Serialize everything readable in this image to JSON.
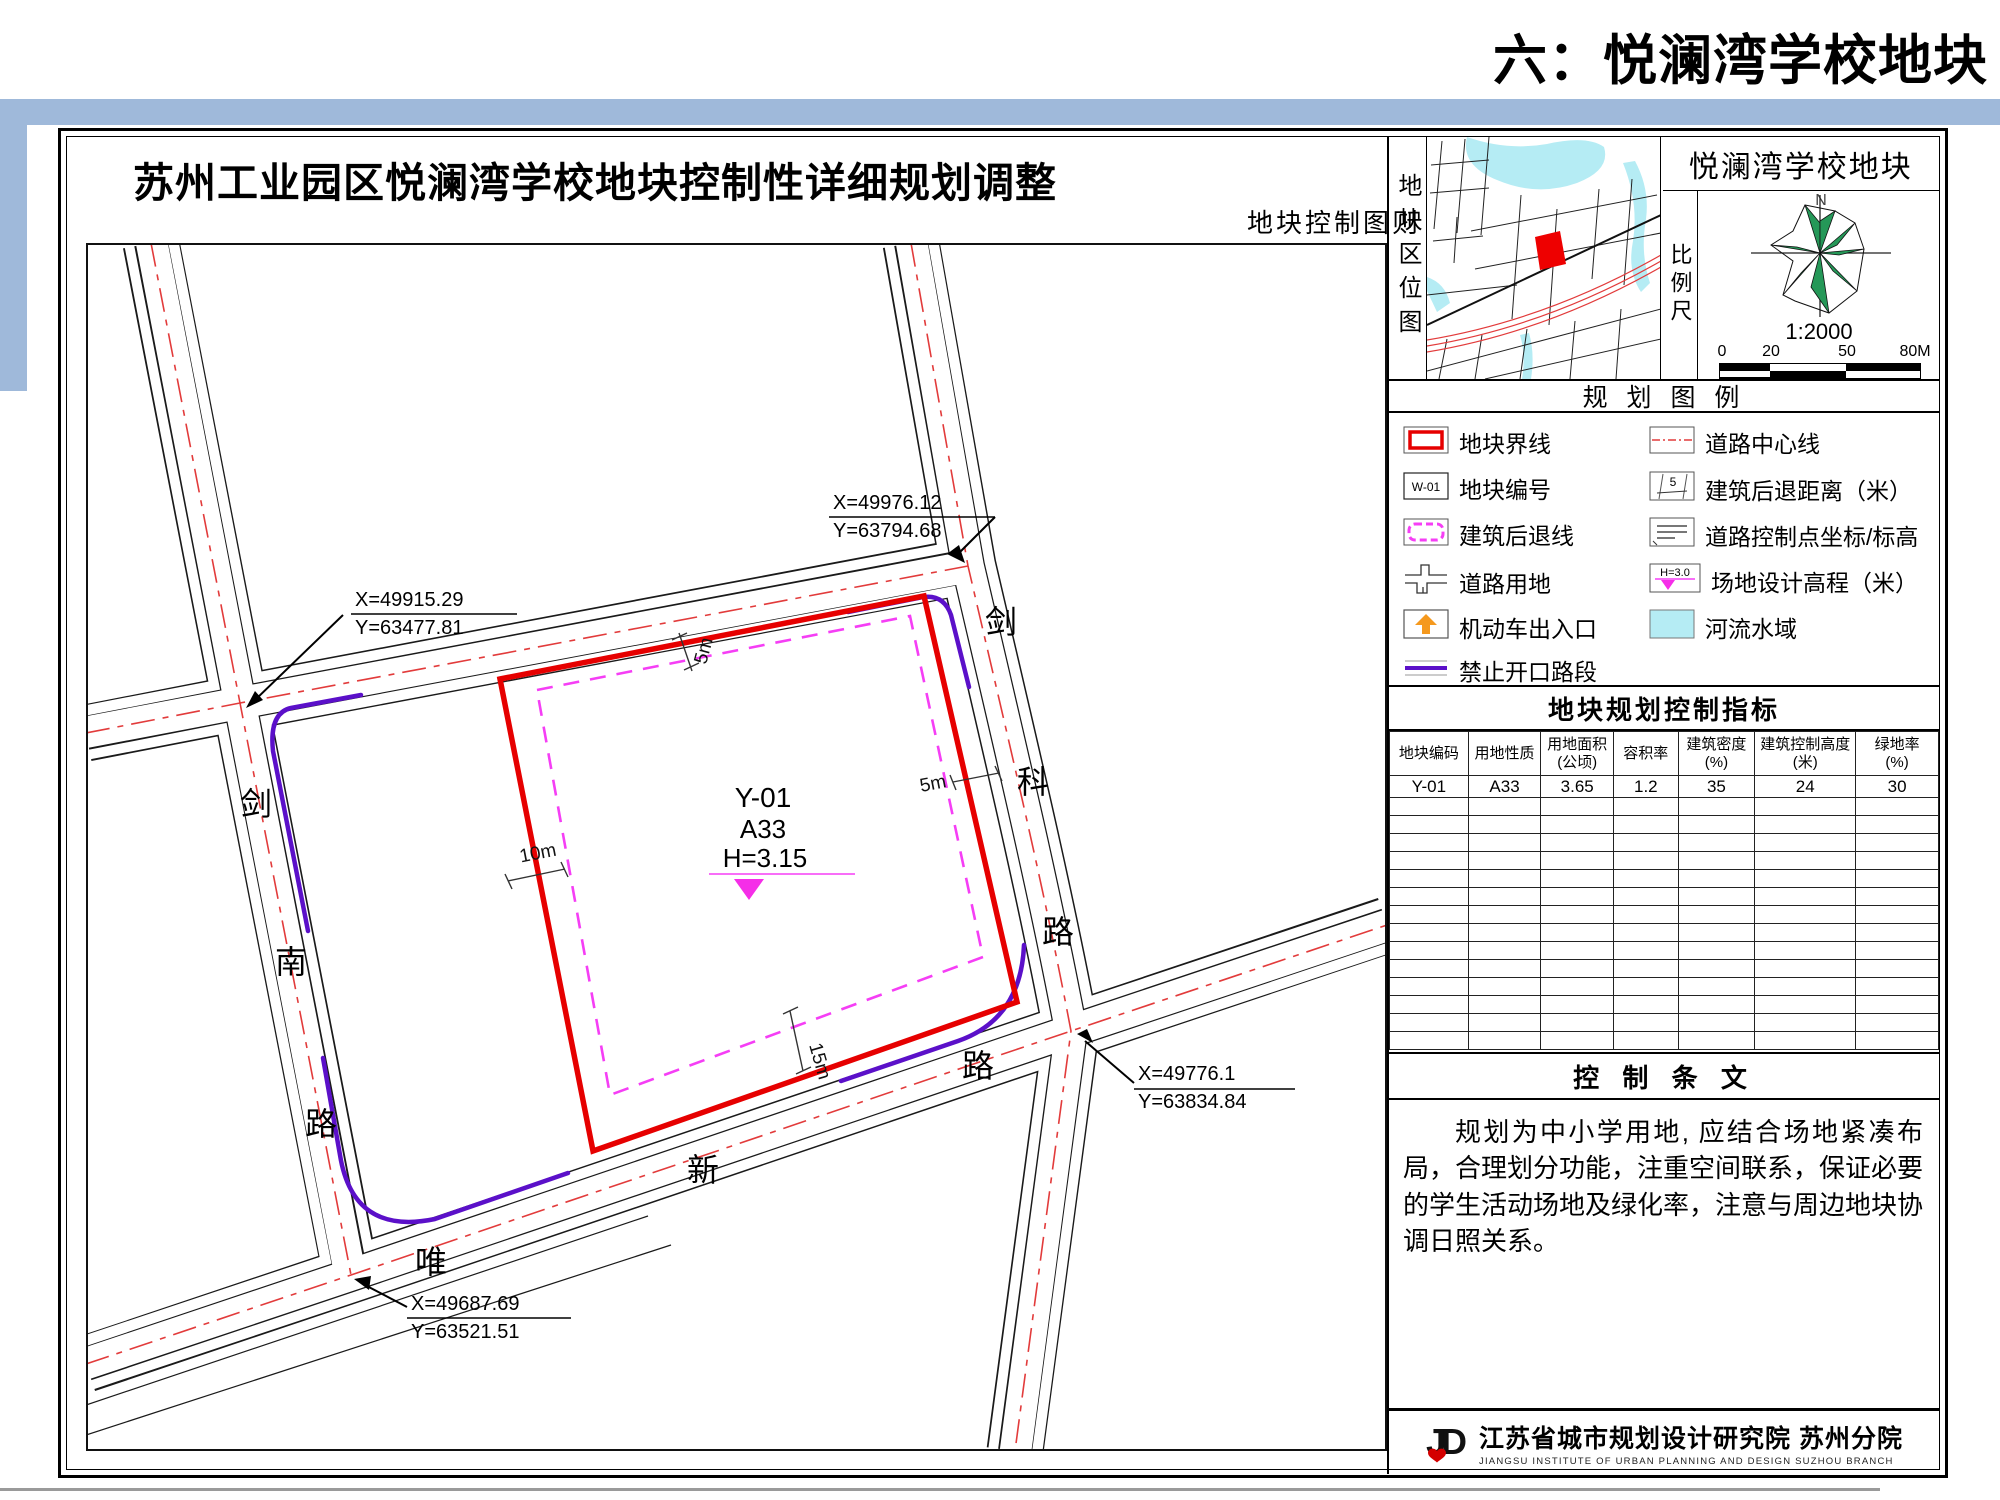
{
  "page": {
    "slide_title": "六：悦澜湾学校地块"
  },
  "sheet": {
    "title": "苏州工业园区悦澜湾学校地块控制性详细规划调整",
    "subtitle": "地块控制图则"
  },
  "map": {
    "plot": {
      "code": "Y-01",
      "land_use": "A33",
      "elevation": "H=3.15"
    },
    "road_names": {
      "west": [
        "剑",
        "南",
        "路"
      ],
      "east": [
        "剑",
        "科",
        "路"
      ],
      "south": [
        "唯",
        "新",
        "路"
      ]
    },
    "dimensions": {
      "north": "5m",
      "east": "5m",
      "west": "10m",
      "south": "15m"
    },
    "callouts": {
      "west": {
        "x": "X=49915.29",
        "y": "Y=63477.81"
      },
      "north": {
        "x": "X=49976.12",
        "y": "Y=63794.68"
      },
      "east": {
        "x": "X=49776.1",
        "y": "Y=63834.84"
      },
      "south": {
        "x": "X=49687.69",
        "y": "Y=63521.51"
      }
    }
  },
  "panel": {
    "location_label": "地块区位图",
    "title": "悦澜湾学校地块",
    "compass_north": "N",
    "scale": {
      "label": "比例尺",
      "ratio": "1:2000",
      "ticks": [
        "0",
        "20",
        "50",
        "80M"
      ]
    },
    "legend": {
      "title": "规 划 图 例",
      "items_left": [
        "地块界线",
        "地块编号",
        "建筑后退线",
        "道路用地",
        "机动车出入口",
        "禁止开口路段"
      ],
      "items_right": [
        "道路中心线",
        "建筑后退距离（米）",
        "道路控制点坐标/标高",
        "场地设计高程（米）",
        "河流水域"
      ],
      "plot_number_sample": "W-01",
      "setback_sample": "5",
      "elevation_sample": "H=3.0"
    },
    "table": {
      "title": "地块规划控制指标",
      "columns": [
        "地块编码",
        "用地性质",
        "用地面积\n(公顷)",
        "容积率",
        "建筑密度\n(%)",
        "建筑控制高度\n(米)",
        "绿地率\n(%)"
      ],
      "row": [
        "Y-01",
        "A33",
        "3.65",
        "1.2",
        "35",
        "24",
        "30"
      ]
    },
    "provisions": {
      "title": "控 制 条 文",
      "text": "规划为中小学用地, 应结合场地紧凑布局，合理划分功能，注重空间联系，保证必要的学生活动场地及绿化率，注意与周边地块协调日照关系。"
    },
    "footer": {
      "logo": "JD",
      "cn": "江苏省城市规划设计研究院 苏州分院",
      "en": "JIANGSU INSTITUTE OF URBAN PLANNING AND DESIGN   SUZHOU BRANCH"
    }
  }
}
